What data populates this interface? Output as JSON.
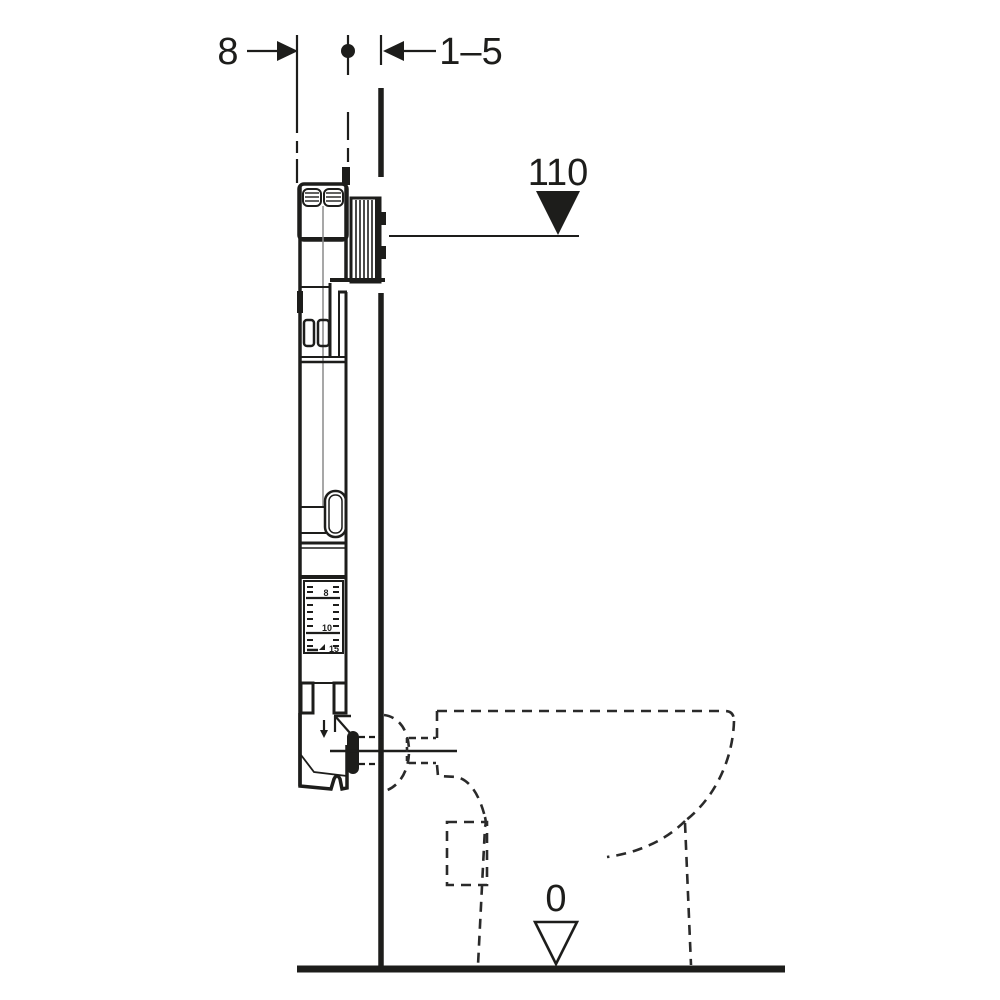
{
  "page": {
    "background": "#ffffff",
    "ink_color": "#1d1d1b",
    "description": "Technical installation diagram of a concealed cistern frame in a wall section with dashed toilet outline"
  },
  "annotations": {
    "wall_thickness_dim": "8",
    "finish_layer_dim": "1–5",
    "upper_level": "110",
    "floor_level": "0"
  },
  "ruler": {
    "labels": [
      "8",
      "10",
      "15"
    ]
  }
}
